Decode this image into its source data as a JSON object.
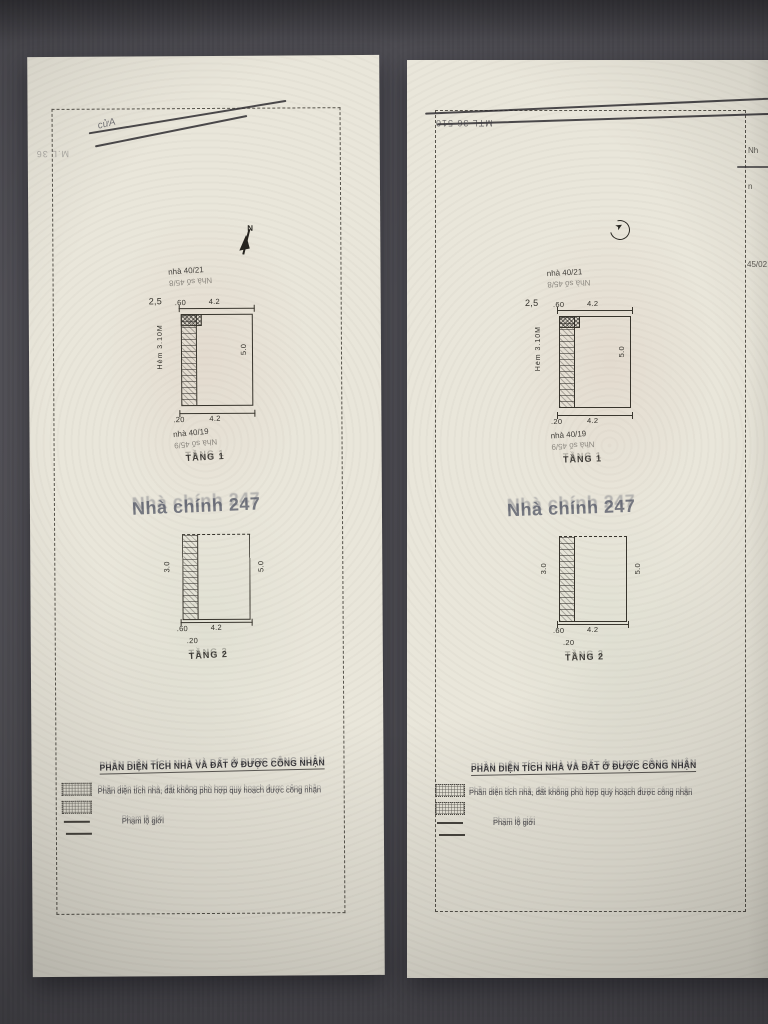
{
  "photo": {
    "background_color": "#8f8e93",
    "paper_color": "#e9e6da"
  },
  "marks": {
    "left_corner_serial": "M.L 36",
    "left_scribble": "cửA",
    "right_serial": "MTL 36 510"
  },
  "plan": {
    "north_label": "N",
    "neighbor_top": {
      "line1": "nhà 40/21",
      "line2": "Nhà số 45/8"
    },
    "neighbor_bottom": {
      "line1": "nhà 40/19",
      "line2": "Nhà số 45/9"
    },
    "floor1": {
      "label": "TẦNG 1",
      "dim_offset": "2,5",
      "dim_top_a": ".60",
      "dim_top_b": "4.2",
      "dim_right": "5.0",
      "dim_alley": "Hẻm 3.10M",
      "dim_bottom_a": ".20",
      "dim_bottom_b": "4.2"
    },
    "floor2": {
      "label": "TẦNG 2",
      "dim_left": "3.0",
      "dim_right": "5.0",
      "dim_bottom_a": ".60",
      "dim_bottom_b": "4.2",
      "dim_bottom_c": ".20"
    },
    "watermark": "Nhà chính 247"
  },
  "legend": {
    "heading": "PHẦN DIỆN TÍCH NHÀ VÀ ĐẤT Ở ĐƯỢC CÔNG NHẬN",
    "line2": "Phần diện tích nhà, đất không phù hợp quy hoạch được công nhận",
    "line3": "Phạm lộ giới"
  },
  "edge_fragments": {
    "f1": "Nh",
    "f2": "n",
    "f3": "45/02"
  }
}
